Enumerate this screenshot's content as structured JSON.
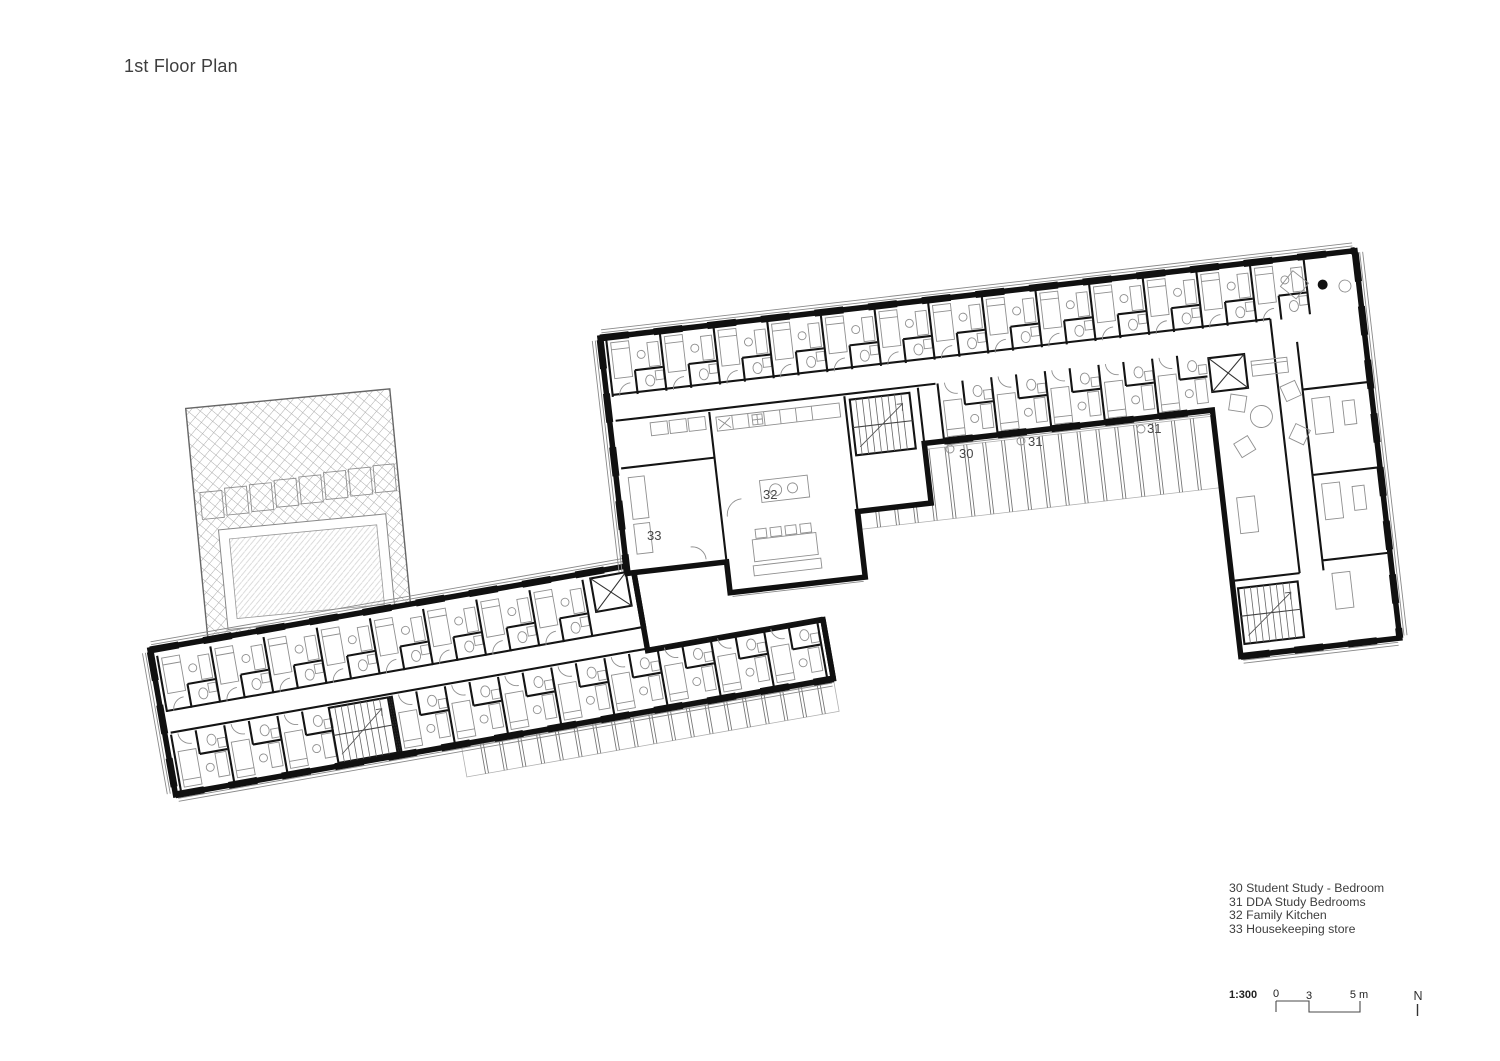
{
  "title": "1st Floor Plan",
  "legend": {
    "items": [
      "30 Student Study - Bedroom",
      "31 DDA Study Bedrooms",
      "32 Family Kitchen",
      "33 Housekeeping store"
    ]
  },
  "plan": {
    "room_labels": [
      "30",
      "31",
      "31",
      "32",
      "33"
    ]
  },
  "scale_bar": {
    "ratio": "1:300",
    "ticks": [
      "0",
      "3",
      "5 m"
    ]
  },
  "north": {
    "label": "N"
  },
  "colors": {
    "wall": "#101010",
    "furniture_line": "#8f8f8f",
    "hatch_line": "#ababab",
    "text": "#3e3e3e",
    "background": "#ffffff"
  }
}
